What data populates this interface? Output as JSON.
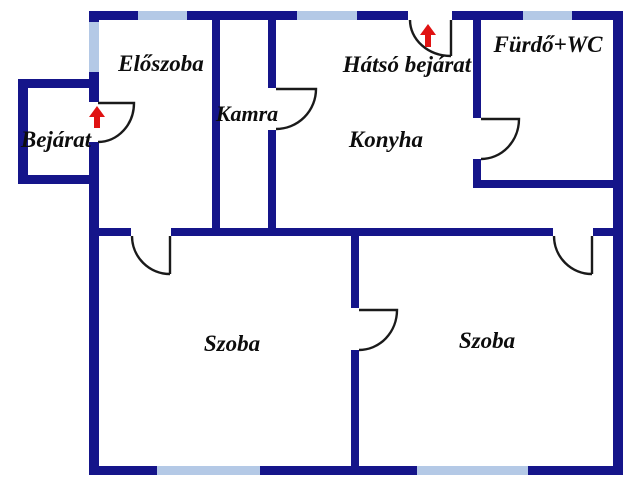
{
  "colors": {
    "wall": "#15158a",
    "window": "#b4c9e6",
    "door": "#1a1a1a",
    "arrow": "#e01212",
    "text": "#0d0d0d",
    "background": "#ffffff"
  },
  "labels": {
    "eloszoba": "Előszoba",
    "kamra": "Kamra",
    "hatso_bejarat": "Hátsó bejárat",
    "furdo_wc": "Fürdő+WC",
    "konyha": "Konyha",
    "bejarat": "Bejárat",
    "szoba_left": "Szoba",
    "szoba_right": "Szoba"
  },
  "icons": {
    "bejarat_arrow": "up-arrow",
    "hatso_bejarat_arrow": "up-arrow"
  }
}
